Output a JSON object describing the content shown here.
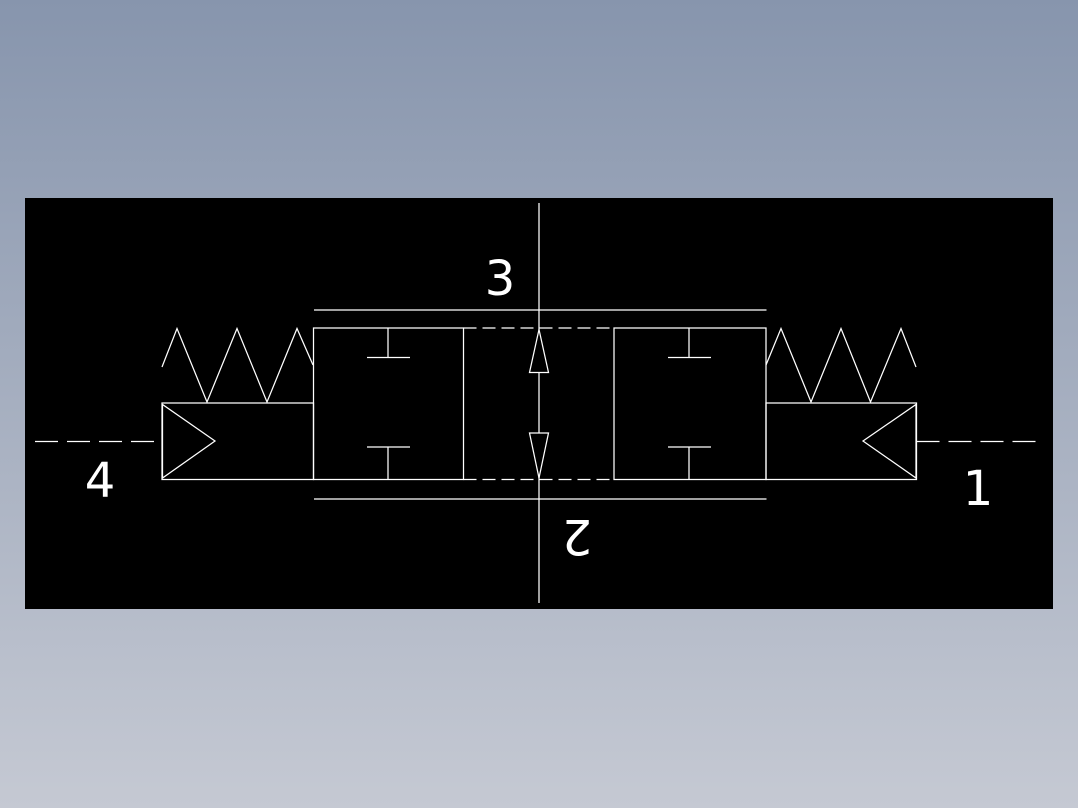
{
  "viewer": {
    "background_top_color": "#8795ad",
    "background_bottom_color": "#c5c9d3",
    "canvas_color": "#000000",
    "line_color": "#ffffff",
    "text_color": "#ffffff"
  },
  "schematic": {
    "labels": {
      "top": "3",
      "bottom": "2",
      "left": "4",
      "right": "1"
    }
  }
}
